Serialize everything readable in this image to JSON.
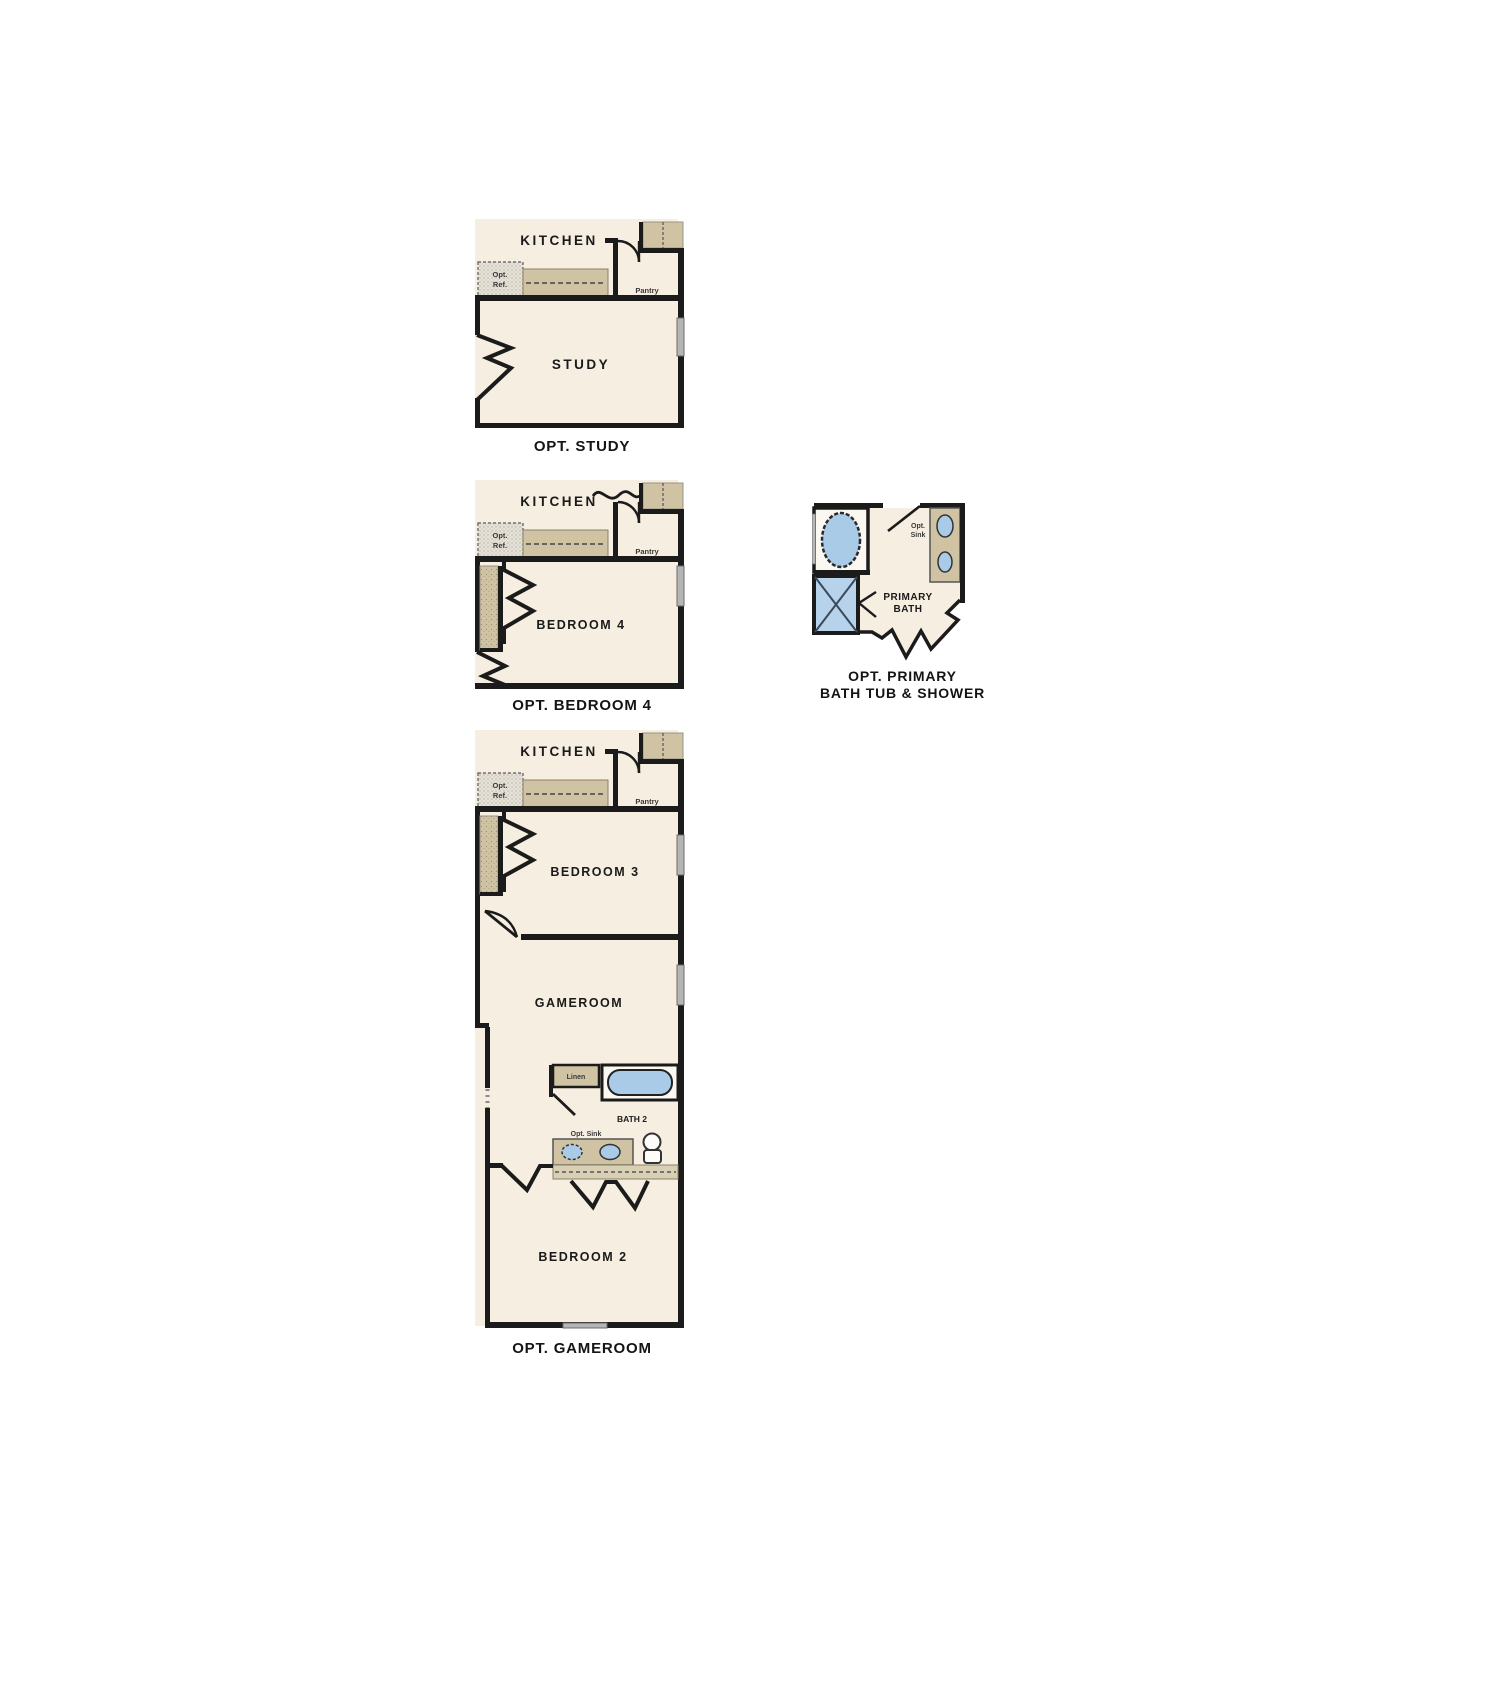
{
  "document": {
    "type": "floor-plan-options-sheet",
    "background": "#ffffff"
  },
  "colors": {
    "wall": "#1b1b1b",
    "room_cream": "#f6eee1",
    "counter_tan": "#cfc3a4",
    "fixture_blue": "#a9cbe7",
    "shower_blue": "#b7d3eb",
    "window_gray": "#b5b5b5",
    "stipple_gray": "#e6e2d8"
  },
  "plans": {
    "opt_study": {
      "caption": "OPT. STUDY",
      "labels": {
        "kitchen": "KITCHEN",
        "opt_ref_line1": "Opt.",
        "opt_ref_line2": "Ref.",
        "pantry": "Pantry",
        "room": "STUDY"
      }
    },
    "opt_bedroom4": {
      "caption": "OPT. BEDROOM 4",
      "labels": {
        "kitchen": "KITCHEN",
        "opt_ref_line1": "Opt.",
        "opt_ref_line2": "Ref.",
        "pantry": "Pantry",
        "room": "BEDROOM 4"
      }
    },
    "opt_primary_bath": {
      "caption_line1": "OPT. PRIMARY",
      "caption_line2": "BATH TUB & SHOWER",
      "labels": {
        "room_line1": "PRIMARY",
        "room_line2": "BATH",
        "opt_sink_line1": "Opt.",
        "opt_sink_line2": "Sink"
      }
    },
    "opt_gameroom": {
      "caption": "OPT. GAMEROOM",
      "labels": {
        "kitchen": "KITCHEN",
        "opt_ref_line1": "Opt.",
        "opt_ref_line2": "Ref.",
        "pantry": "Pantry",
        "bedroom3": "BEDROOM 3",
        "gameroom": "GAMEROOM",
        "linen": "Linen",
        "bath2": "BATH 2",
        "opt_sink": "Opt. Sink",
        "bedroom2": "BEDROOM 2"
      }
    }
  }
}
